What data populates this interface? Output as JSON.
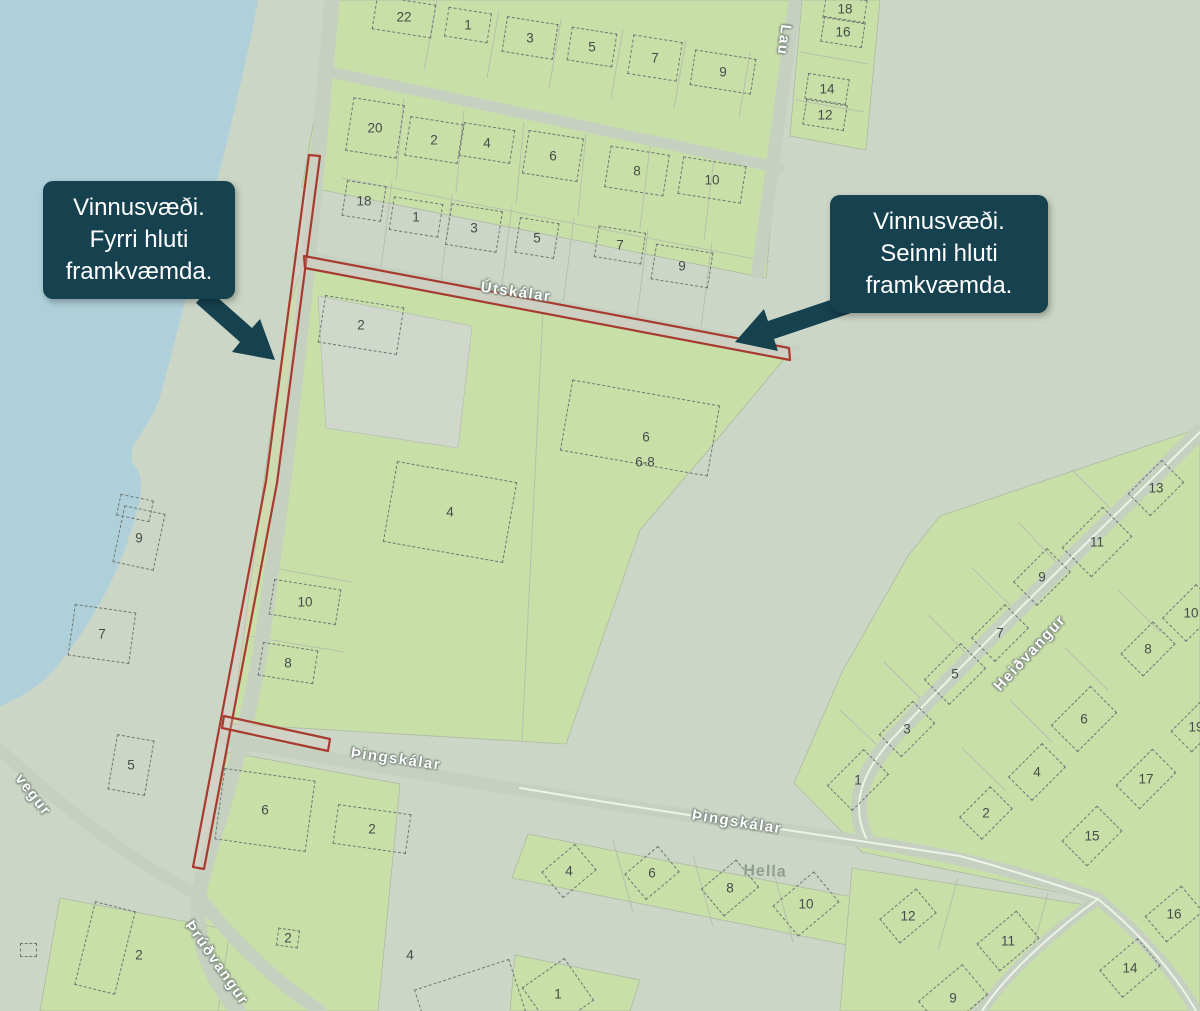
{
  "map": {
    "callouts": [
      {
        "id": "first-phase",
        "lines": [
          "Vinnusvæði.",
          "Fyrri hluti",
          "framkvæmda."
        ]
      },
      {
        "id": "second-phase",
        "lines": [
          "Vinnusvæði.",
          "Seinni hluti",
          "framkvæmda."
        ]
      }
    ],
    "street_labels": [
      {
        "id": "laufskalar-partial",
        "text": "Lau",
        "x": 784,
        "y": 40,
        "rot": 97
      },
      {
        "id": "utskalar",
        "text": "Útskálar",
        "x": 516,
        "y": 292,
        "rot": 8
      },
      {
        "id": "thingskalar-west",
        "text": "Þingskálar",
        "x": 396,
        "y": 759,
        "rot": 8
      },
      {
        "id": "thingskalar-east",
        "text": "Þingskálar",
        "x": 737,
        "y": 822,
        "rot": 9
      },
      {
        "id": "heidvangur",
        "text": "Heiðvangur",
        "x": 1030,
        "y": 653,
        "rot": -47
      },
      {
        "id": "thrudvangur",
        "text": "Þrúðvangur",
        "x": 217,
        "y": 963,
        "rot": 55
      },
      {
        "id": "vegur-partial",
        "text": "vegur",
        "x": 33,
        "y": 795,
        "rot": 52
      }
    ],
    "place_labels": [
      {
        "id": "hella",
        "text": "Hella",
        "x": 765,
        "y": 872,
        "rot": 2
      }
    ],
    "houses": [
      {
        "n": "22",
        "x": 404,
        "y": 17,
        "r": 9,
        "w": 60,
        "h": 34
      },
      {
        "n": "1",
        "x": 468,
        "y": 25,
        "r": 9,
        "w": 44,
        "h": 30
      },
      {
        "n": "3",
        "x": 530,
        "y": 38,
        "r": 9,
        "w": 52,
        "h": 36
      },
      {
        "n": "5",
        "x": 592,
        "y": 47,
        "r": 9,
        "w": 46,
        "h": 34
      },
      {
        "n": "7",
        "x": 655,
        "y": 58,
        "r": 9,
        "w": 50,
        "h": 40
      },
      {
        "n": "9",
        "x": 723,
        "y": 72,
        "r": 9,
        "w": 62,
        "h": 36
      },
      {
        "n": "18",
        "x": 845,
        "y": 9,
        "r": 9,
        "w": 42,
        "h": 24
      },
      {
        "n": "16",
        "x": 843,
        "y": 32,
        "r": 9,
        "w": 42,
        "h": 26
      },
      {
        "n": "14",
        "x": 827,
        "y": 89,
        "r": 9,
        "w": 42,
        "h": 26
      },
      {
        "n": "12",
        "x": 825,
        "y": 115,
        "r": 9,
        "w": 42,
        "h": 26
      },
      {
        "n": "20",
        "x": 375,
        "y": 128,
        "r": 9,
        "w": 52,
        "h": 54
      },
      {
        "n": "2",
        "x": 434,
        "y": 140,
        "r": 9,
        "w": 54,
        "h": 40
      },
      {
        "n": "4",
        "x": 487,
        "y": 143,
        "r": 9,
        "w": 52,
        "h": 34
      },
      {
        "n": "6",
        "x": 553,
        "y": 156,
        "r": 9,
        "w": 56,
        "h": 44
      },
      {
        "n": "8",
        "x": 637,
        "y": 171,
        "r": 9,
        "w": 60,
        "h": 42
      },
      {
        "n": "10",
        "x": 712,
        "y": 180,
        "r": 9,
        "w": 64,
        "h": 38
      },
      {
        "n": "18",
        "x": 364,
        "y": 201,
        "r": 9,
        "w": 40,
        "h": 36
      },
      {
        "n": "1",
        "x": 416,
        "y": 217,
        "r": 9,
        "w": 50,
        "h": 34
      },
      {
        "n": "3",
        "x": 474,
        "y": 228,
        "r": 9,
        "w": 52,
        "h": 42
      },
      {
        "n": "5",
        "x": 537,
        "y": 238,
        "r": 9,
        "w": 40,
        "h": 36
      },
      {
        "n": "7",
        "x": 620,
        "y": 245,
        "r": 9,
        "w": 48,
        "h": 32
      },
      {
        "n": "9",
        "x": 682,
        "y": 266,
        "r": 9,
        "w": 58,
        "h": 36
      },
      {
        "n": "2",
        "x": 361,
        "y": 325,
        "r": 9,
        "w": 80,
        "h": 48
      },
      {
        "n": "4",
        "x": 450,
        "y": 512,
        "r": 10,
        "w": 122,
        "h": 82
      },
      {
        "n": "",
        "x": 640,
        "y": 428,
        "r": 10,
        "w": 150,
        "h": 72
      },
      {
        "n": "6",
        "x": 646,
        "y": 437,
        "r": 0,
        "w": 0,
        "h": 0
      },
      {
        "n": "6-8",
        "x": 645,
        "y": 462,
        "r": 0,
        "w": 0,
        "h": 0
      },
      {
        "n": "10",
        "x": 305,
        "y": 602,
        "r": 9,
        "w": 68,
        "h": 36
      },
      {
        "n": "8",
        "x": 288,
        "y": 663,
        "r": 9,
        "w": 56,
        "h": 34
      },
      {
        "n": "",
        "x": 135,
        "y": 508,
        "r": 12,
        "w": 34,
        "h": 22
      },
      {
        "n": "9",
        "x": 139,
        "y": 538,
        "r": 12,
        "w": 42,
        "h": 58
      },
      {
        "n": "7",
        "x": 102,
        "y": 634,
        "r": 8,
        "w": 62,
        "h": 52
      },
      {
        "n": "5",
        "x": 131,
        "y": 765,
        "r": 10,
        "w": 38,
        "h": 56
      },
      {
        "n": "6",
        "x": 265,
        "y": 810,
        "r": 8,
        "w": 92,
        "h": 72
      },
      {
        "n": "2",
        "x": 372,
        "y": 829,
        "r": 8,
        "w": 74,
        "h": 40
      },
      {
        "n": "2",
        "x": 139,
        "y": 955,
        "r": 15,
        "w": 0,
        "h": 0
      },
      {
        "n": "",
        "x": 105,
        "y": 948,
        "r": 14,
        "w": 42,
        "h": 86
      },
      {
        "n": "2",
        "x": 288,
        "y": 938,
        "r": 8,
        "w": 22,
        "h": 18
      },
      {
        "n": "4",
        "x": 410,
        "y": 955,
        "r": 0,
        "w": 0,
        "h": 0
      },
      {
        "n": "",
        "x": 470,
        "y": 1000,
        "r": -18,
        "w": 100,
        "h": 55
      },
      {
        "n": "1",
        "x": 558,
        "y": 994,
        "r": -35,
        "w": 52,
        "h": 52
      },
      {
        "n": "4",
        "x": 569,
        "y": 871,
        "r": -40,
        "w": 44,
        "h": 34
      },
      {
        "n": "6",
        "x": 652,
        "y": 873,
        "r": -40,
        "w": 44,
        "h": 34
      },
      {
        "n": "8",
        "x": 730,
        "y": 888,
        "r": -40,
        "w": 46,
        "h": 36
      },
      {
        "n": "10",
        "x": 806,
        "y": 904,
        "r": -40,
        "w": 54,
        "h": 40
      },
      {
        "n": "13",
        "x": 1156,
        "y": 488,
        "r": -45,
        "w": 48,
        "h": 32
      },
      {
        "n": "11",
        "x": 1097,
        "y": 542,
        "r": -45,
        "w": 58,
        "h": 42
      },
      {
        "n": "9",
        "x": 1042,
        "y": 577,
        "r": -45,
        "w": 48,
        "h": 34
      },
      {
        "n": "7",
        "x": 1000,
        "y": 633,
        "r": -45,
        "w": 48,
        "h": 34
      },
      {
        "n": "5",
        "x": 955,
        "y": 674,
        "r": -45,
        "w": 52,
        "h": 36
      },
      {
        "n": "3",
        "x": 907,
        "y": 729,
        "r": -45,
        "w": 48,
        "h": 32
      },
      {
        "n": "1",
        "x": 858,
        "y": 780,
        "r": -45,
        "w": 52,
        "h": 36
      },
      {
        "n": "10",
        "x": 1191,
        "y": 613,
        "r": -45,
        "w": 48,
        "h": 34
      },
      {
        "n": "8",
        "x": 1148,
        "y": 649,
        "r": -45,
        "w": 46,
        "h": 32
      },
      {
        "n": "6",
        "x": 1084,
        "y": 719,
        "r": -45,
        "w": 56,
        "h": 38
      },
      {
        "n": "4",
        "x": 1037,
        "y": 772,
        "r": -45,
        "w": 48,
        "h": 34
      },
      {
        "n": "2",
        "x": 986,
        "y": 813,
        "r": -45,
        "w": 44,
        "h": 32
      },
      {
        "n": "17",
        "x": 1146,
        "y": 779,
        "r": -45,
        "w": 52,
        "h": 34
      },
      {
        "n": "15",
        "x": 1092,
        "y": 836,
        "r": -45,
        "w": 50,
        "h": 36
      },
      {
        "n": "19",
        "x": 1196,
        "y": 727,
        "r": -45,
        "w": 42,
        "h": 30
      },
      {
        "n": "12",
        "x": 908,
        "y": 916,
        "r": -40,
        "w": 48,
        "h": 32
      },
      {
        "n": "11",
        "x": 1008,
        "y": 941,
        "r": -40,
        "w": 52,
        "h": 36
      },
      {
        "n": "9",
        "x": 953,
        "y": 998,
        "r": -40,
        "w": 58,
        "h": 40
      },
      {
        "n": "14",
        "x": 1130,
        "y": 968,
        "r": -40,
        "w": 50,
        "h": 36
      },
      {
        "n": "16",
        "x": 1174,
        "y": 914,
        "r": -40,
        "w": 48,
        "h": 34
      },
      {
        "n": "",
        "x": 28,
        "y": 950,
        "r": 0,
        "w": 17,
        "h": 14
      }
    ],
    "work_areas": [
      {
        "id": "work-area-first-phase-street"
      },
      {
        "id": "work-area-utskalar"
      },
      {
        "id": "work-area-thingskalar"
      }
    ],
    "colors": {
      "water": "#afd0da",
      "parcel_green": "#c8dfa8",
      "land_gray_green": "#ccd6c7",
      "road": "#c6d0c1",
      "work_area_red": "#a83b30",
      "callout_bg": "#16414f",
      "callout_text": "#ffffff",
      "street_label": "#ffffff",
      "house_number": "#454d49"
    }
  }
}
